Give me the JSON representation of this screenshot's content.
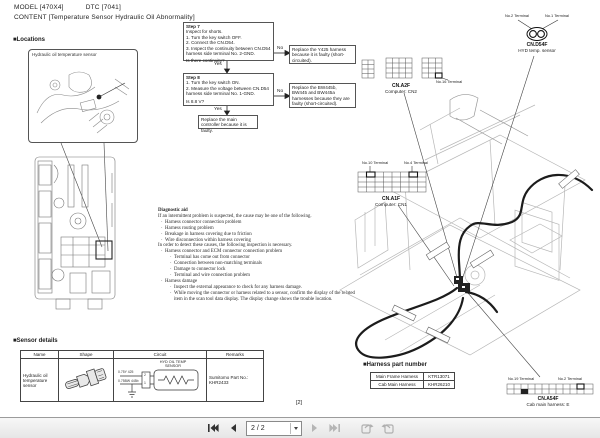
{
  "header": {
    "model": "MODEL [470X4]",
    "dtc": "DTC [7041]",
    "content": "CONTENT [Temperature Sensor Hydraulic Oil Abnormality]"
  },
  "locations": {
    "title": "■Locations",
    "inset_label": "Hydraulic oil temperature sensor"
  },
  "flowchart": {
    "yes_label": "Yes",
    "no_label": "No",
    "step7": {
      "title": "Step 7",
      "lines": [
        "Inspect for shorts.",
        "1. Turn the key switch OFF.",
        "2. Connect the CN.D54.",
        "3. Inspect the continuity between CN.D54",
        "    harness side terminal No. 2-GND."
      ],
      "question": "Is there continuity?"
    },
    "step7_no": "Replace the Y425 harness because it is faulty (short-circuited).",
    "step8": {
      "title": "Step 8",
      "lines": [
        "1. Turn the key switch ON.",
        "2. Measure the voltage between CN.D54",
        "    harness side terminal No. 1-GND."
      ],
      "question": "Is 8.8 V?"
    },
    "step8_no": "Replace the BW445b, BW445 and BW445a harnesses because they are faulty (short-circuited).",
    "final": "Replace the main controller because it is faulty."
  },
  "diagnostic_aid": {
    "title": "Diagnostic aid",
    "intro": "If an intermittent problem is suspected, the cause may be one of the following.",
    "causes": [
      "Harness connector connection problem",
      "Harness routing problem",
      "Breakage in harness covering due to friction",
      "Wire disconnection within harness covering"
    ],
    "detect": "In order to detect these causes, the following inspection is necessary.",
    "inspection_header": "Harness connector and ECM connector connection problem",
    "inspection_items": [
      "Terminal has come out from connector",
      "Connection between non-matching terminals",
      "Damage to connector lock",
      "Terminal and wire connection problem"
    ],
    "damage_header": "Harness damage",
    "damage_items": [
      "Inspect the external appearance to check for any harness damage.",
      "While moving the connector or harness related to a sensor, confirm the display of the related item in the scan tool data display. The display change shows the trouble location."
    ]
  },
  "connectors": {
    "d54f": {
      "terminal2": "No.2 Terminal",
      "terminal1": "No.1 Terminal",
      "name": "CN.D54F",
      "desc": "HYD temp. sensor"
    },
    "a2f": {
      "name": "CN.A2F",
      "desc": "Computer: CN2",
      "terminal16": "No.16 Terminal"
    },
    "a1f": {
      "name": "CN.A1F",
      "desc": "Computer: CN1",
      "terminal10": "No.10 Terminal",
      "terminal4": "No.4 Terminal"
    },
    "a54f": {
      "name": "CN.A54F",
      "desc": "Cab main harness: E",
      "terminal19": "No.19 Terminal",
      "terminal2": "No.2 Terminal"
    }
  },
  "harness_table": {
    "title": "■Harness part number",
    "rows": [
      {
        "name": "Main Frame Harness",
        "part": "KTR13071"
      },
      {
        "name": "Cab Main Harness",
        "part": "KHR26210"
      }
    ]
  },
  "sensor_details": {
    "title": "■Sensor details",
    "headers": [
      "Name",
      "Shape",
      "Circuit",
      "Remarks"
    ],
    "name": "Hydraulic oil temperature sensor",
    "circuit_label_1": "HYD OIL TEMP",
    "circuit_label_2": "SENSOR",
    "wire1": "0.75Y 425",
    "wire2": "0.75BW 445b",
    "pin2": "2",
    "pin1": "1",
    "remarks": "Sumitomo Part No.: KHR2433"
  },
  "footer": {
    "page_label": "[2]"
  },
  "toolbar": {
    "page_display": "2 / 2"
  }
}
